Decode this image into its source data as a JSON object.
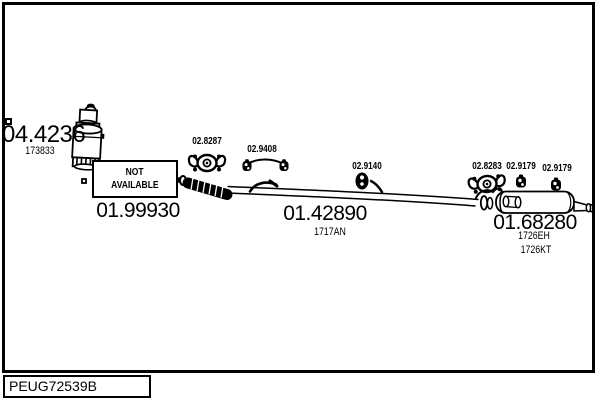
{
  "colors": {
    "ink": "#000000",
    "background": "#ffffff"
  },
  "diagram_code": "PEUG72539B",
  "parts": {
    "front_pipe": {
      "number": "04.4236",
      "ref": "173833"
    },
    "catalytic_converter": {
      "number": "01.99930",
      "availability_line1": "NOT",
      "availability_line2": "AVAILABLE"
    },
    "clamp_front": {
      "number": "02.8287"
    },
    "mounting_kit": {
      "number": "02.9408"
    },
    "centre_pipe": {
      "number": "01.42890",
      "ref": "1717AN"
    },
    "rubber_hanger_centre": {
      "number": "02.9140"
    },
    "clamp_rear": {
      "number": "02.8283"
    },
    "rubber_hanger_rear_1": {
      "number": "02.9179"
    },
    "rubber_hanger_rear_2": {
      "number": "02.9179"
    },
    "rear_silencer": {
      "number": "01.68280",
      "refs": [
        "1726EH",
        "1726KT"
      ]
    }
  }
}
